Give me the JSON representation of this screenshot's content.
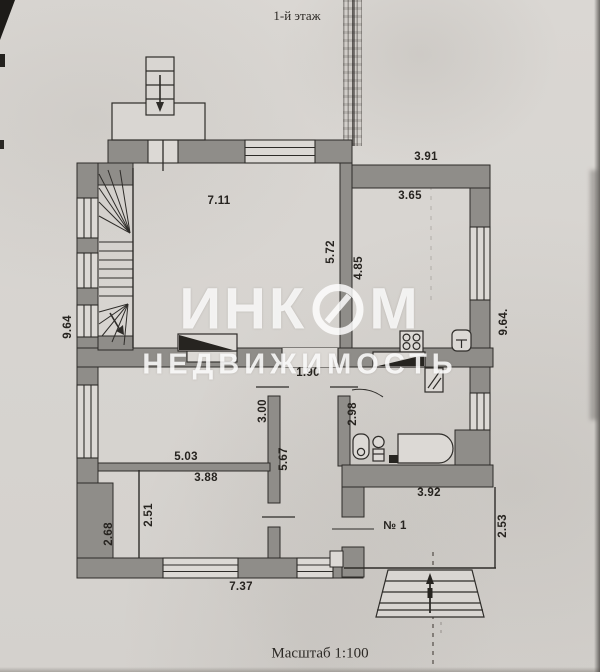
{
  "title": "1-й этаж",
  "scale_label": "Масштаб 1:100",
  "watermark": {
    "part1": "ИНК",
    "part2": "М",
    "line2": "НЕДВИЖИМОСТЬ"
  },
  "room_number": "№ 1",
  "dims": {
    "top_width": "3.91",
    "kitchen_width": "3.65",
    "living_width": "7.11",
    "living_height": "5.72",
    "kitchen_height": "4.85",
    "left_height": "9.64",
    "right_height": "9.64.",
    "hall_width": "1.90",
    "left_room_height": "3.00",
    "bath_height": "2.98",
    "hall_height": "5.67",
    "left_room_width": "5.03",
    "bottom_room_width": "3.88",
    "bottom_room_height": "2.51",
    "left_bottom_height": "2.68",
    "bottom_width": "7.37",
    "veranda_width": "3.92",
    "veranda_height": "2.53"
  },
  "colors": {
    "wall": "#8f8d89",
    "line": "#2e2c29",
    "paper": "#d8d5d1"
  }
}
